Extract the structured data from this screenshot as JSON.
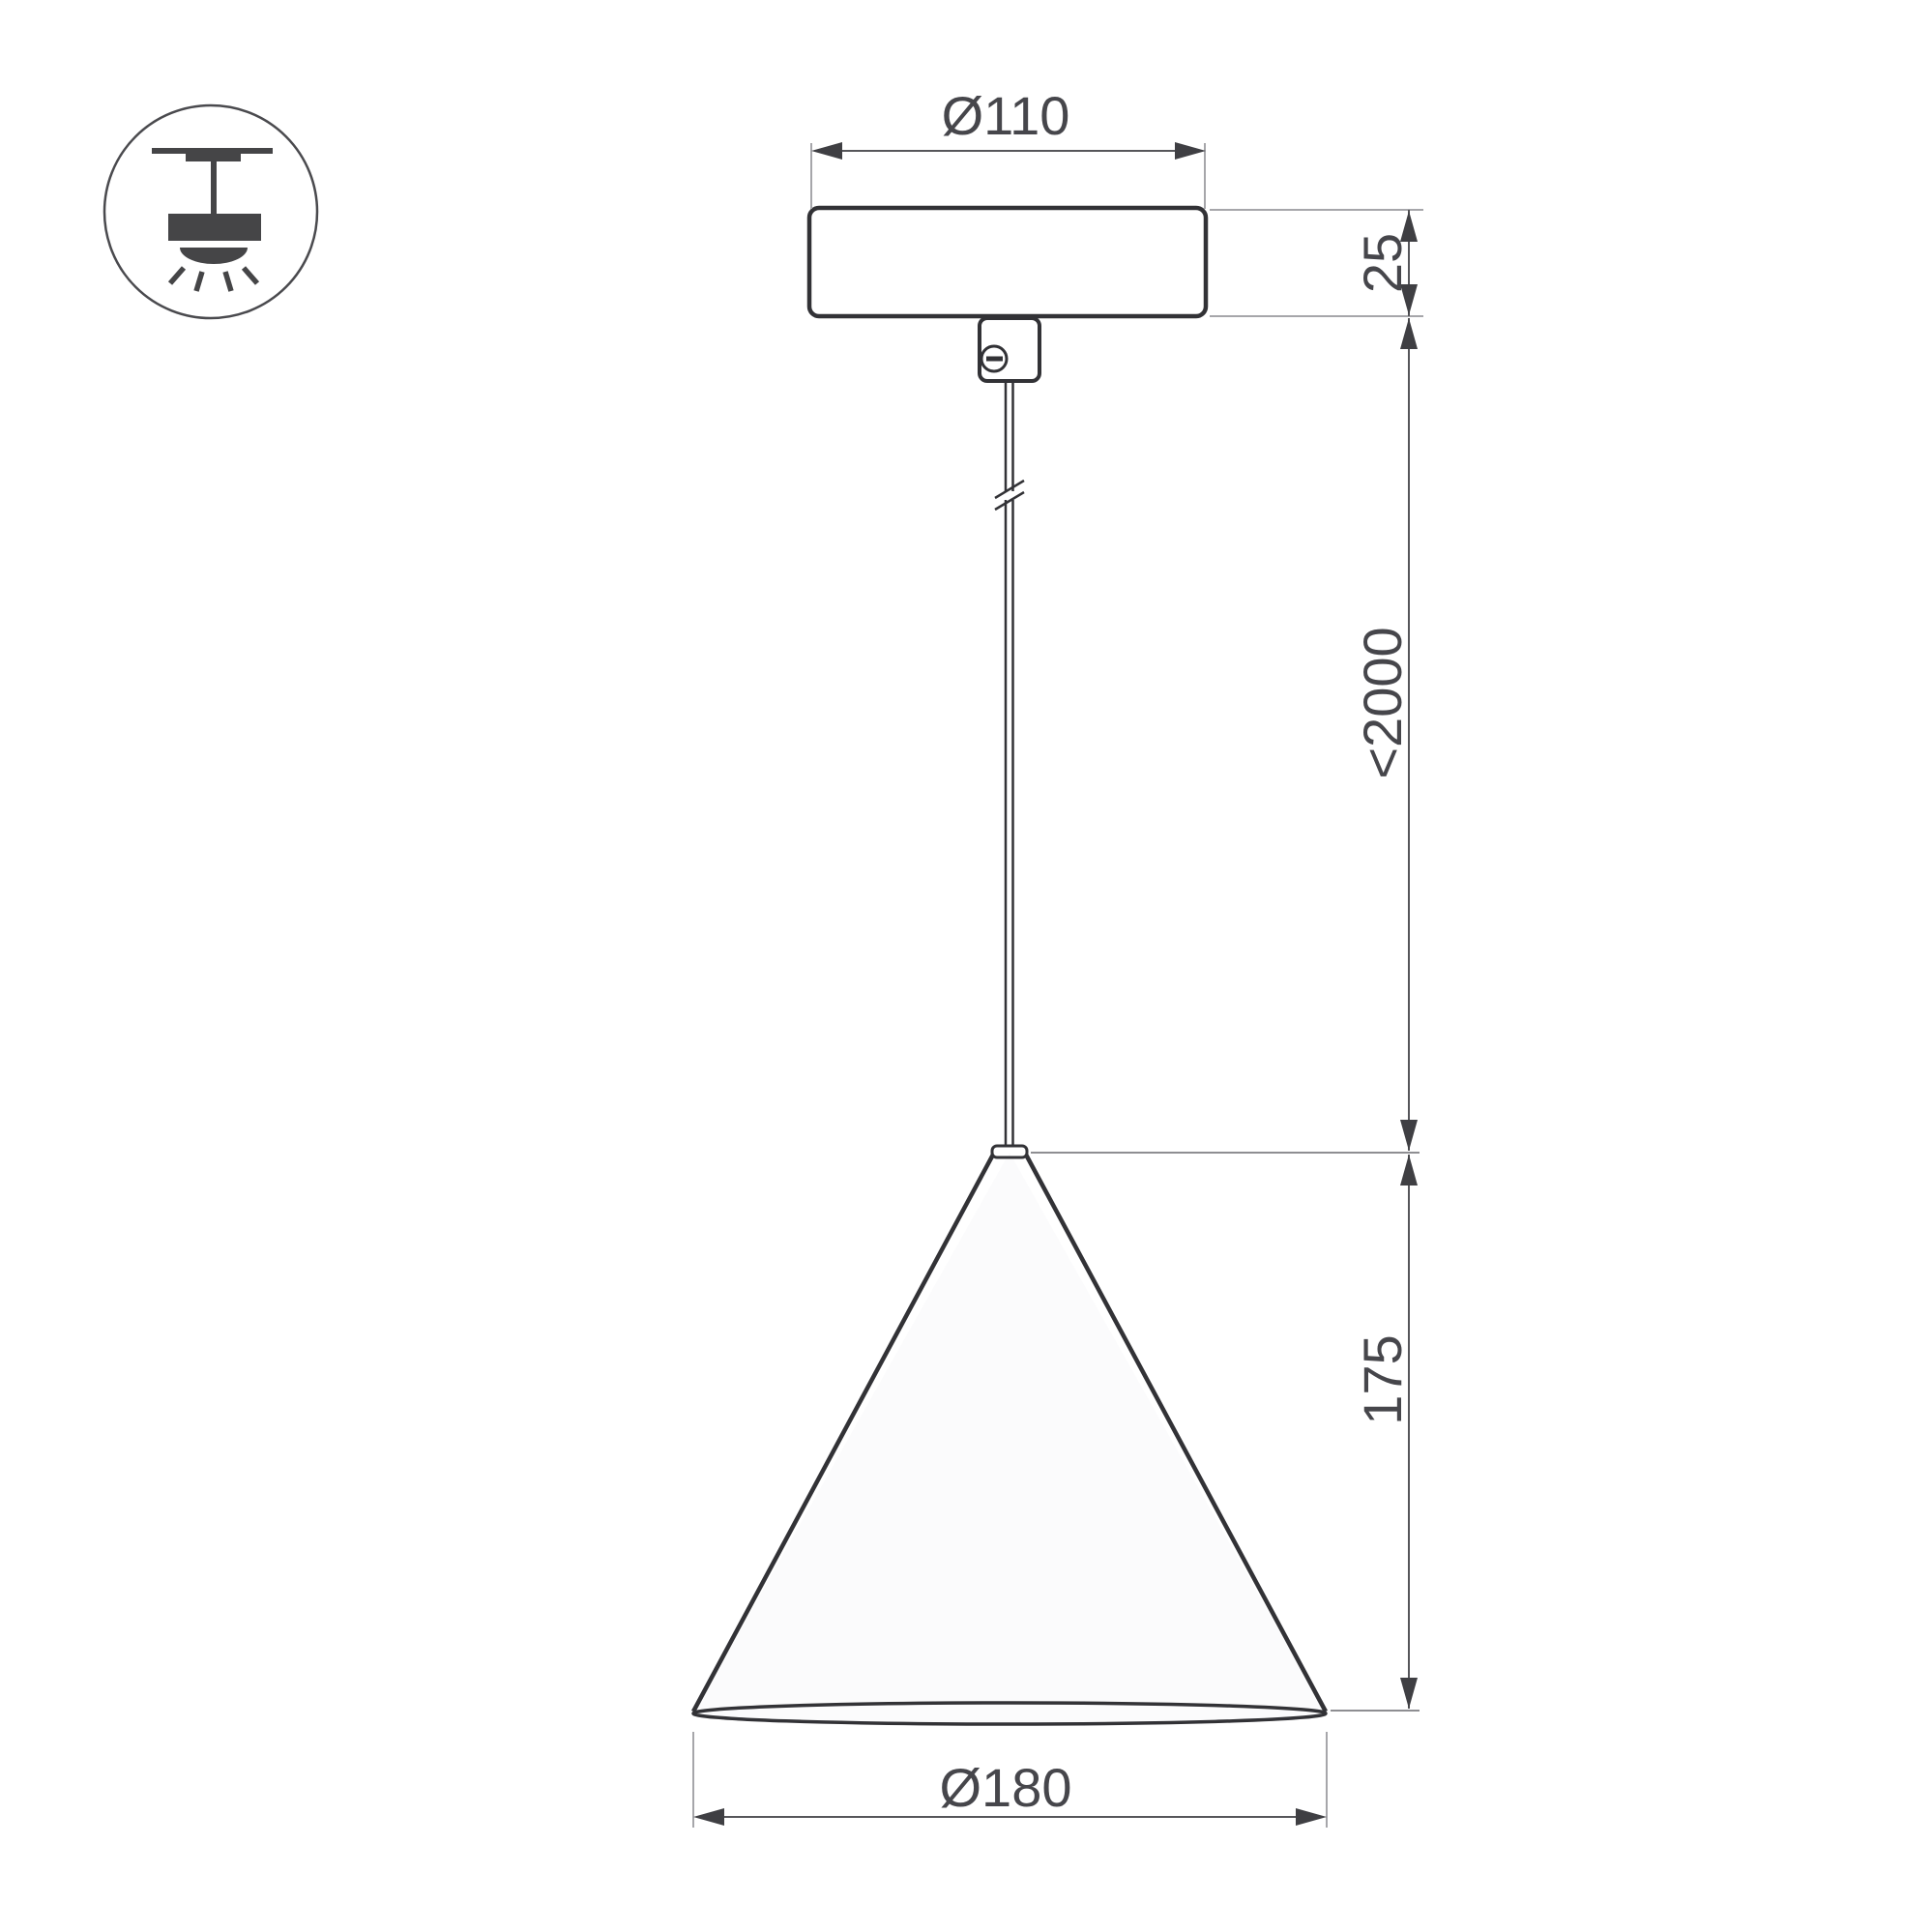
{
  "icon": {
    "name": "pendant-ceiling-light-icon"
  },
  "dimensions": {
    "canopy_diameter": "Ø110",
    "canopy_height": "25",
    "max_suspension": "<2000",
    "shade_height": "175",
    "shade_diameter": "Ø180"
  },
  "colors": {
    "background": "#ffffff",
    "object_line": "#323236",
    "dimension_line": "#56565a",
    "extension_line": "#a6a6aa",
    "arrow": "#3f3f43",
    "text": "#46464b",
    "icon": "#454547",
    "shade_fill": "#fbfbfc"
  }
}
